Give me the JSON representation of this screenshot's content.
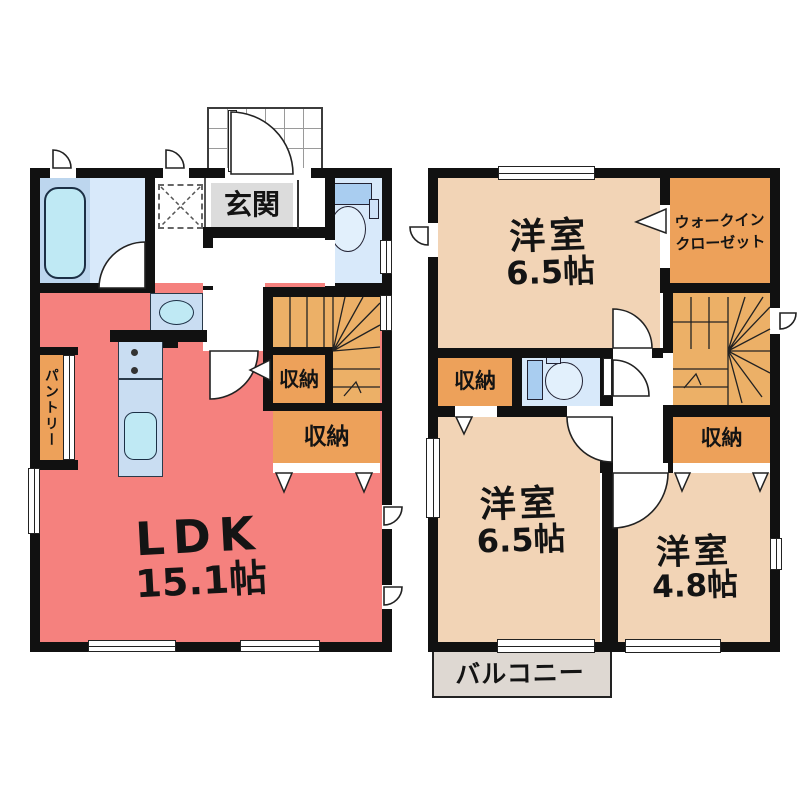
{
  "floor1": {
    "entrance_label": "玄関",
    "pantry_label": "パントリー",
    "ldk_name": "LDK",
    "ldk_size": "15.1帖",
    "storage_small_label": "収納",
    "storage_wide_label": "収納"
  },
  "floor2": {
    "bedroom_top_name": "洋室",
    "bedroom_top_size": "6.5帖",
    "wic_line1": "ウォークイン",
    "wic_line2": "クローゼット",
    "storage_left_label": "収納",
    "storage_right_label": "収納",
    "bedroom_left_name": "洋室",
    "bedroom_left_size": "6.5帖",
    "bedroom_right_name": "洋室",
    "bedroom_right_size": "4.8帖",
    "balcony_label": "バルコニー"
  },
  "colors": {
    "wall": "#111111",
    "ldk": "#f5817e",
    "bedroom": "#f2d4b6",
    "storage": "#eda15a",
    "stairs": "#ecb067",
    "water_room": "#d8e9fa",
    "fixture_blue": "#bfe9f4",
    "counter": "#c9ddf2",
    "bath_strip": "#bdd6ee",
    "entrance_label_bg": "#dcdcdc",
    "balcony": "#ded8d2"
  }
}
